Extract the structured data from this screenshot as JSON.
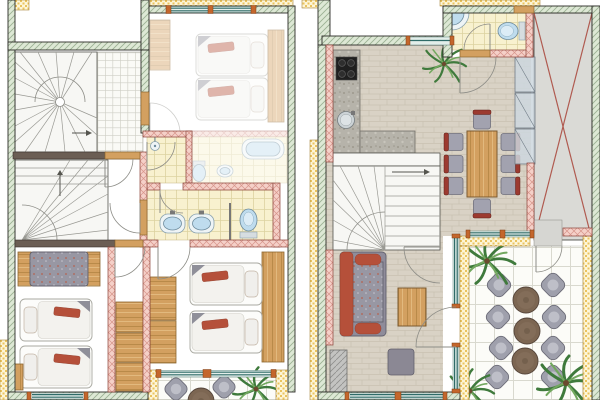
{
  "meta": {
    "title": "Two-storey holiday apartment — colour floor plans",
    "description": "Architectural drawing with two floor plans side by side: sleeping level (left) and living level with terrace (right). No text labels are printed on the drawing.",
    "panel_count": 2
  },
  "colors": {
    "paper": "#ffffff",
    "wall_edge": "#2c2c27",
    "hatch_green_bg": "#dde8d5",
    "hatch_green_line": "#9bb193",
    "hatch_yellow_bg": "#fdf5d6",
    "hatch_yellow_dot": "#eac35e",
    "hatch_pink_bg": "#f5d0c8",
    "hatch_pink_line": "#d6948a",
    "wall_pink_edge": "#8a4238",
    "wall_dark": "#6b5e54",
    "wood": "#d3a060",
    "wood_dark": "#8d6630",
    "wood_grain_dark": "#b98a49",
    "wood_grain_light": "#e2b97e",
    "floor_bg": "#d9d2c5",
    "floor_line": "#c9c1b2",
    "tile_yellow": "#f8f1cf",
    "tile_yellow_line": "#dcd2a0",
    "tile_white": "#fcfcf8",
    "tile_white_line": "#d9d9cf",
    "counter_stone": "#b6b3aa",
    "counter_fleck_dark": "#9d998e",
    "counter_fleck_light": "#c8c5bc",
    "water_blue": "#bfdcee",
    "fixture_edge": "#6d8b9d",
    "fixture_white": "#eef4f6",
    "glass_teal": "#2f6b68",
    "glass_fill": "#e3eeea",
    "frame_orange": "#c4662c",
    "stair_line": "#9a9a94",
    "cross_red": "#b05a50",
    "carport_grey": "#dadad6",
    "sofa_grey": "#9897a3",
    "sofa_fleck_red": "#b5624e",
    "sofa_fleck_light": "#c6c5cf",
    "accent_red": "#b5503a",
    "chair_grey": "#a2a2af",
    "chair_back_red": "#9c3a30",
    "patio_chair_grey": "#9fa0ac",
    "patio_table_brown": "#7c6652",
    "pouf_grey": "#8b8894",
    "plant_green_dark": "#3f7a3c",
    "plant_green_light": "#72a85e",
    "trunk_brown": "#6b4a2f",
    "ghost_opacity": "0.42"
  },
  "plans": [
    {
      "id": "sleeping-level",
      "name": "Sleeping level floor plan (left panel)",
      "position": "left",
      "rooms": [
        {
          "name": "winder-staircase-upper",
          "furniture": [
            "winder stairs",
            "tiled landing",
            "direction arrow"
          ]
        },
        {
          "name": "adjacent-bedroom-ghosted",
          "furniture": [
            "single bed x2",
            "wardrobe",
            "headboard shelf",
            "window"
          ]
        },
        {
          "name": "shower-room",
          "furniture": [
            "shower head"
          ]
        },
        {
          "name": "adjacent-bathroom-ghosted",
          "furniture": [
            "bathtub",
            "washbasin",
            "toilet"
          ]
        },
        {
          "name": "winder-staircase-lower",
          "furniture": [
            "winder stairs"
          ]
        },
        {
          "name": "bathroom",
          "furniture": [
            "washbasin x2",
            "toilet",
            "partition"
          ]
        },
        {
          "name": "bedroom-southwest",
          "furniture": [
            "sofa with wood armrests",
            "single bed x2",
            "nightstand"
          ]
        },
        {
          "name": "bedroom-southeast",
          "furniture": [
            "single bed x2",
            "wardrobe x2",
            "headboard shelf"
          ]
        },
        {
          "name": "hallway-wardrobes",
          "furniture": [
            "wardrobe x3"
          ]
        },
        {
          "name": "balcony",
          "furniture": [
            "patio chair x2",
            "round table",
            "palm plant"
          ]
        }
      ]
    },
    {
      "id": "living-level",
      "name": "Living level floor plan (right panel)",
      "position": "right",
      "rooms": [
        {
          "name": "kitchen",
          "furniture": [
            "cooktop",
            "L-shaped stone counter",
            "round sink"
          ]
        },
        {
          "name": "wc",
          "furniture": [
            "corner washbasin",
            "toilet"
          ]
        },
        {
          "name": "entry-hall",
          "furniture": [
            "door swing",
            "potted palm"
          ]
        },
        {
          "name": "dining-area",
          "furniture": [
            "wooden dining table",
            "dining chair x8",
            "glass cabinet x3"
          ]
        },
        {
          "name": "winder-staircase",
          "furniture": [
            "winder stairs",
            "direction arrow"
          ]
        },
        {
          "name": "living-room",
          "furniture": [
            "sofa with red cushions",
            "wooden coffee table",
            "pouf",
            "hatched planter box"
          ]
        },
        {
          "name": "carport-void-crossed",
          "furniture": [
            "crossed-out grey area"
          ]
        },
        {
          "name": "terrace",
          "furniture": [
            "round table x3",
            "patio chair x8",
            "palm plant x3"
          ]
        }
      ]
    }
  ]
}
